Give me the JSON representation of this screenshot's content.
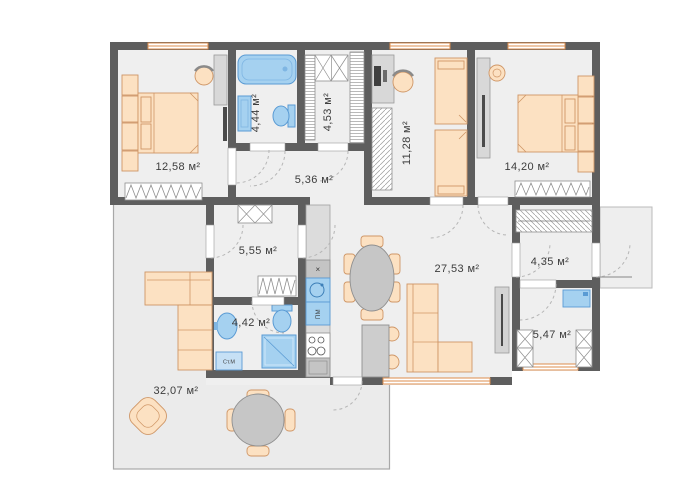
{
  "rooms": {
    "bedroom1": "12,58 м²",
    "bathroom1": "4,44 м²",
    "wardrobe1": "4,53 м²",
    "hallway1": "5,36 м²",
    "kids_room": "11,28 м²",
    "bedroom2": "14,20 м²",
    "hallway2": "5,55 м²",
    "living": "27,53 м²",
    "entry": "4,35 м²",
    "bathroom2": "4,42 м²",
    "laundry": "5,47 м²",
    "terrace": "32,07 м²"
  },
  "appliances": {
    "washing_machine": "Ст.М",
    "dishwasher": "ПМ",
    "hood": "×"
  },
  "colors": {
    "wall": "#5e5e5e",
    "floor": "#efefef",
    "terrace_floor": "#ebebeb",
    "furniture_peach": "#fce1c2",
    "furniture_peach_border": "#cf9666",
    "fixture_blue": "#a5d1f0",
    "fixture_blue_border": "#5a9bd4",
    "window_frame": "#dd8e4d"
  }
}
